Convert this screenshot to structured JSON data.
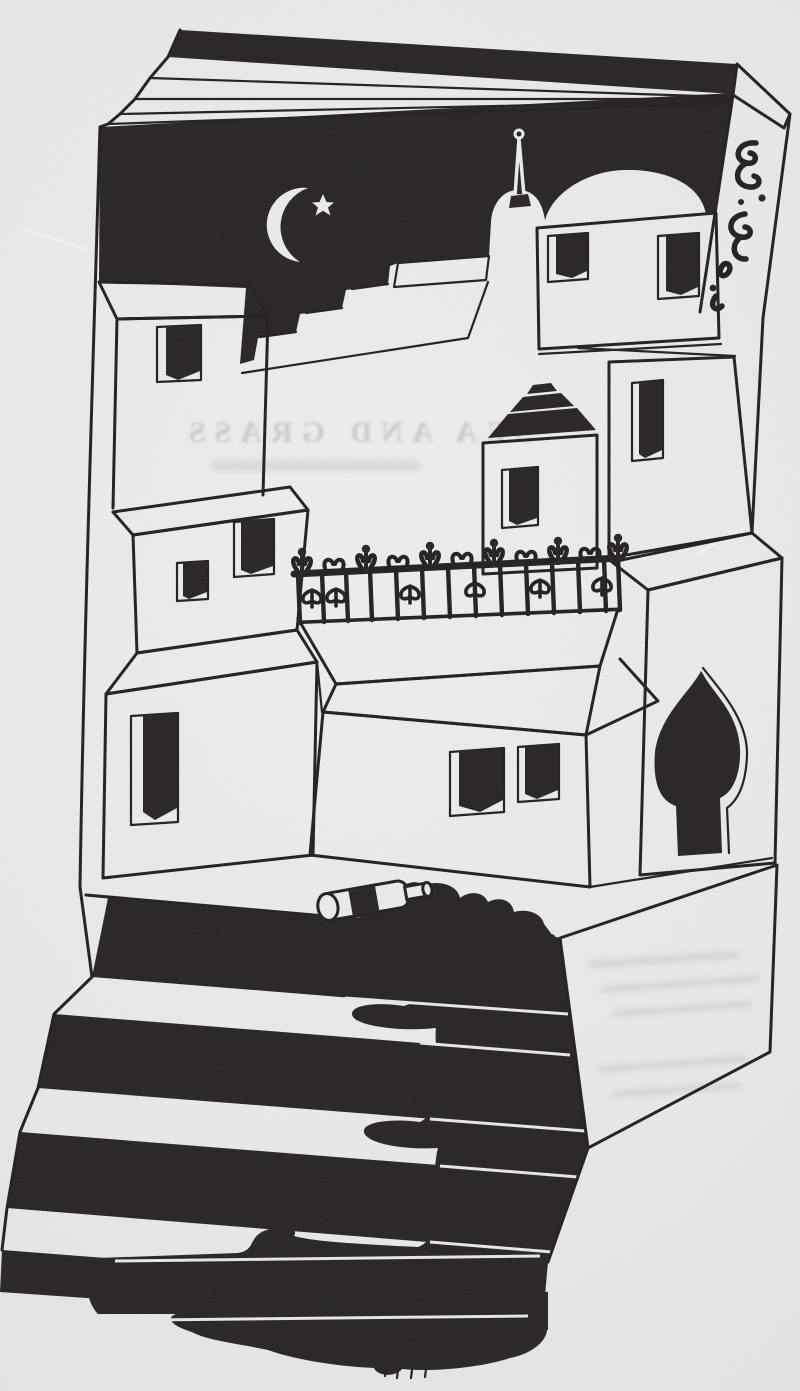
{
  "artwork": {
    "medium": "black-ink book illustration",
    "scene": "Moonlit village with domes, minaret, iron fence and arched doorway built on an open book; a toppled bottle spills dark liquid down a staircase",
    "ghost_text": "SEA AND GRASS",
    "colors": {
      "paper": "#eae7e9",
      "ink": "#242021"
    },
    "elements": [
      "open-book-pages",
      "book-spine-calligraphy",
      "night-sky",
      "crescent-moon",
      "star",
      "minaret-spire",
      "small-dome",
      "large-dome",
      "dome-building",
      "rooftop-steps",
      "left-buildings",
      "windows",
      "middle-house",
      "stepped-roof-tower",
      "right-tower",
      "wrought-iron-fence",
      "pointed-arch-doorway",
      "terrace",
      "toppled-bottle",
      "ink-spill",
      "staircase",
      "liquid-pool"
    ]
  }
}
